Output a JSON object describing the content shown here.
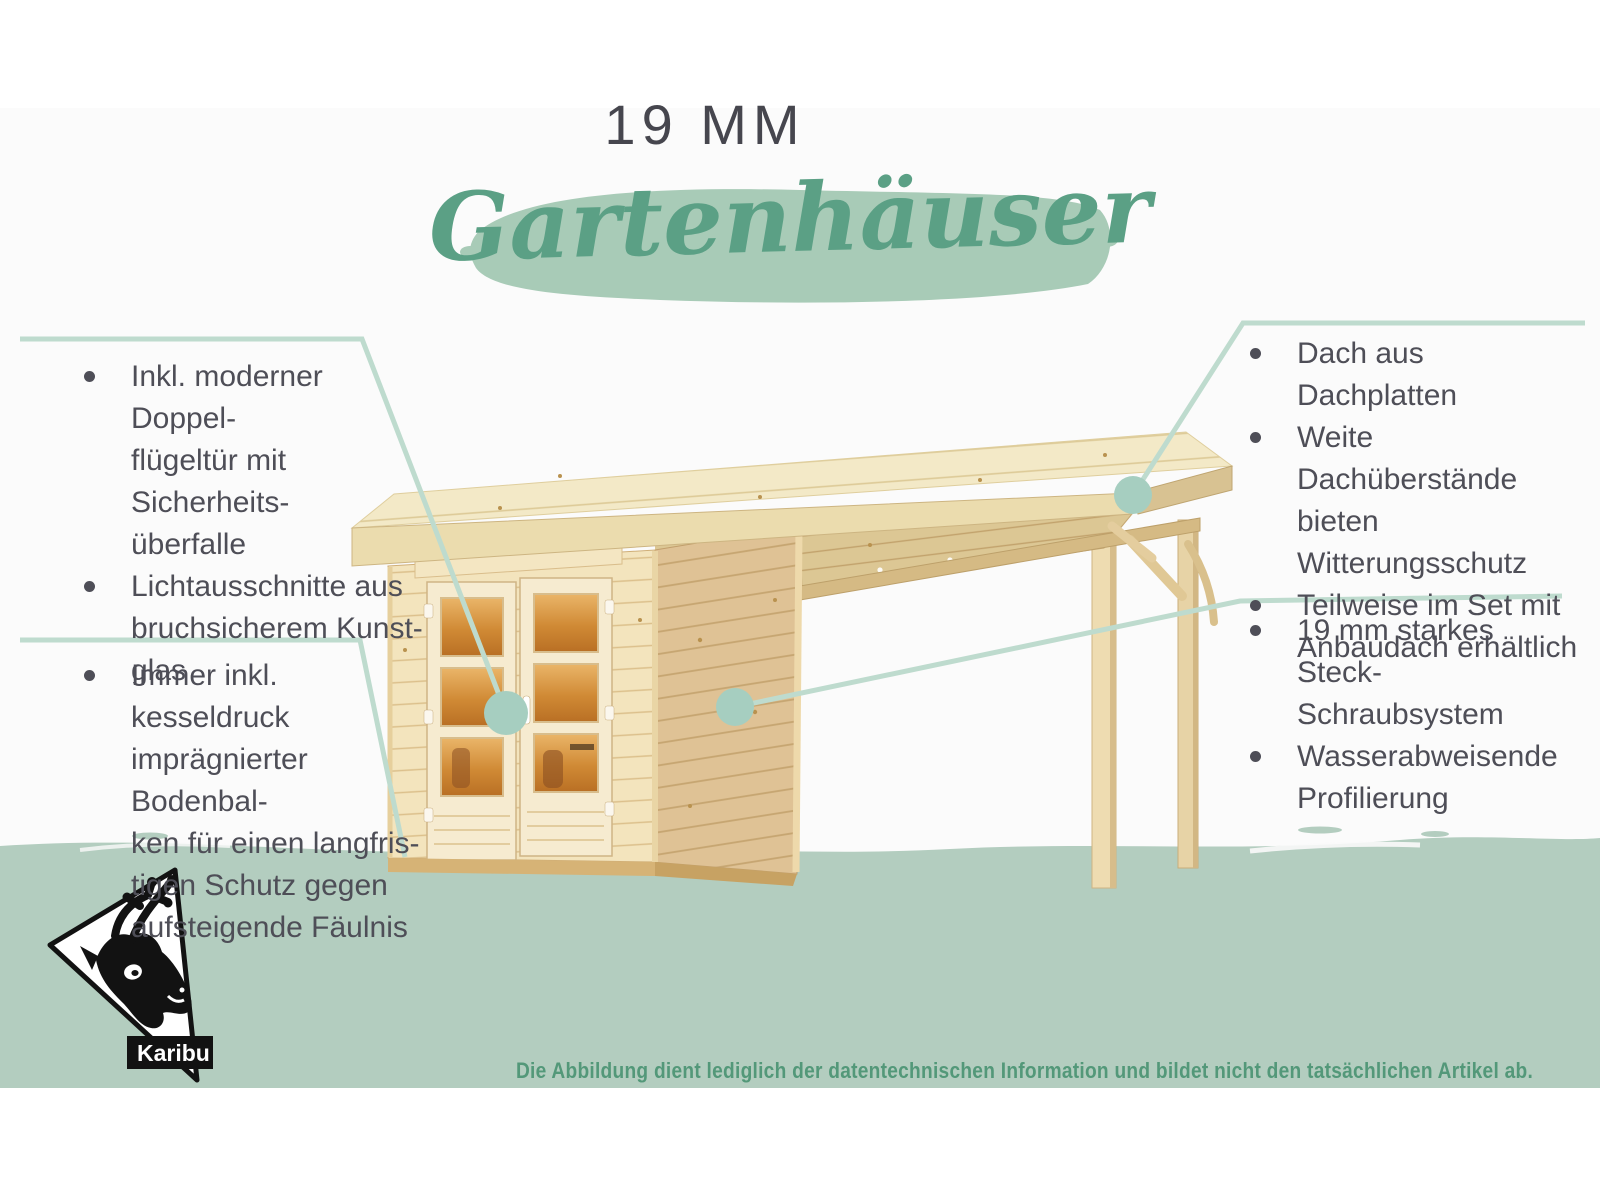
{
  "title": {
    "kicker": "19 MM",
    "headline": "Gartenhäuser"
  },
  "features": {
    "left_top": {
      "items": [
        {
          "text": "Inkl. moderner Doppel-\nflügeltür mit Sicherheits-\nüberfalle"
        },
        {
          "text": "Lichtausschnitte aus\nbruchsicherem Kunst-\nglas"
        }
      ]
    },
    "left_bottom": {
      "items": [
        {
          "text": "Immer inkl. kesseldruck\nimprägnierter Bodenbal-\nken für einen langfris-\ntigen Schutz gegen\naufsteigende Fäulnis"
        }
      ]
    },
    "right_top": {
      "items": [
        {
          "text": "Dach aus Dachplatten"
        },
        {
          "text": "Weite Dachüberstände\nbieten Witterungsschutz"
        },
        {
          "text": "Teilweise im Set mit\nAnbaudach erhältlich"
        }
      ]
    },
    "right_bottom": {
      "items": [
        {
          "text": "19 mm starkes Steck-\nSchraubsystem"
        },
        {
          "text": "Wasserabweisende\nProfilierung"
        }
      ]
    }
  },
  "logo": {
    "label": "Karibu"
  },
  "footer": {
    "disclaimer": "Die Abbildung dient lediglich der datentechnischen Information und bildet nicht den tatsächlichen Artikel ab."
  },
  "illustration": {
    "subject": "Holz-Gartenhaus mit Flachdach und seitlichem Anbaudach"
  },
  "colors": {
    "headline_green": "#5ba085",
    "brush_green": "#a8cbb7",
    "band_green": "#b3cdbf",
    "callout_line": "#bedbce",
    "callout_dot": "#a6cec0",
    "text": "#4e4e57",
    "disclaimer_green": "#539879"
  }
}
